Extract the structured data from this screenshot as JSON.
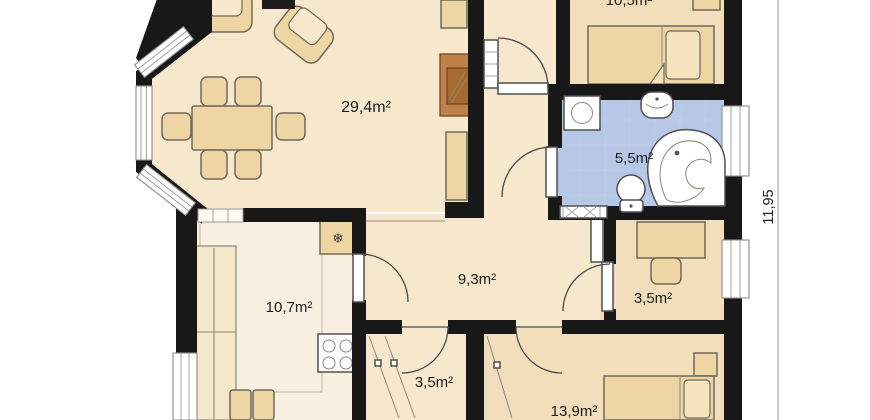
{
  "rooms": {
    "living": {
      "area": "29,4m²"
    },
    "kitchen": {
      "area": "10,7m²"
    },
    "hall": {
      "area": "9,3m²"
    },
    "bathroom": {
      "area": "5,5m²"
    },
    "bedroom_top": {
      "area": "10,5m²"
    },
    "bedroom_bottom": {
      "area": "13,9m²"
    },
    "closet": {
      "area": "3,5m²"
    },
    "study": {
      "area": "3,5m²"
    }
  },
  "dimensions": {
    "right_side": "11,95"
  },
  "icons": {
    "fridge": "❄"
  },
  "colors": {
    "wall": "#181818",
    "floor": "#f7e8cd",
    "floor_bedroom": "#f2deba",
    "floor_kitchen": "#f8efe0",
    "floor_bath": "#b7c8e6",
    "furniture": "#eed5a4",
    "furniture_light": "#f4e3bd",
    "fireplace": "#c08148",
    "fireplace_inner": "#a96a2f",
    "outline": "#6f6a5a",
    "door": "#4a4a4a",
    "window_frame": "#8c8c8c",
    "label": "#1c1c1c",
    "dim_line": "#9a9a9a"
  }
}
